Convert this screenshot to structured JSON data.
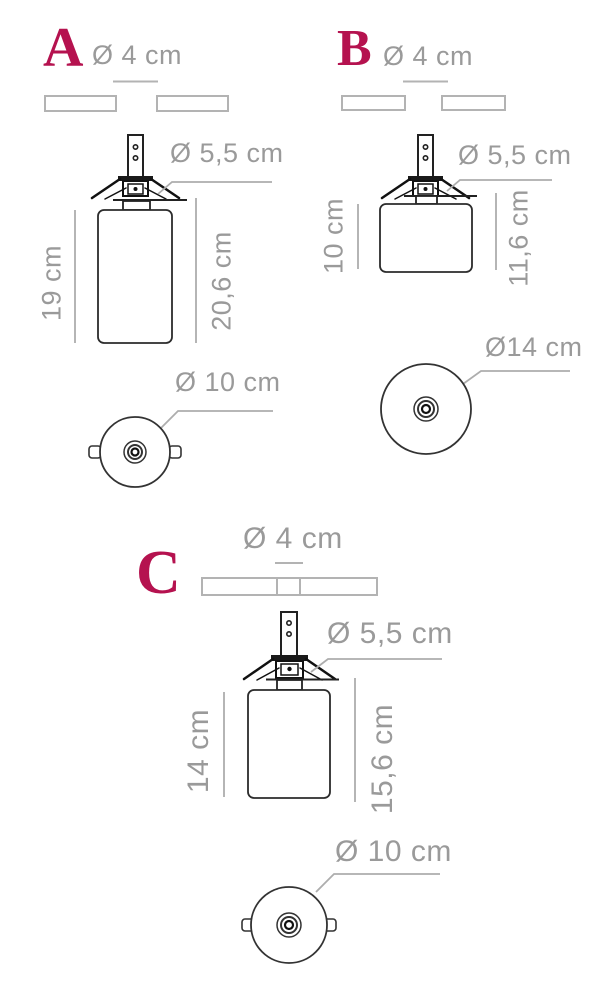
{
  "palette": {
    "accent": "#b5124f",
    "label_gray": "#9a9a9a",
    "line_gray": "#adadad",
    "line_dark": "#1f1f1f"
  },
  "variants": [
    {
      "id": "a",
      "letter": "A",
      "canopy_diameter": "Ø 4 cm",
      "clip_diameter": "Ø 5,5 cm",
      "body_height": "19 cm",
      "total_height": "20,6 cm",
      "bottom_diameter": "Ø 10 cm"
    },
    {
      "id": "b",
      "letter": "B",
      "canopy_diameter": "Ø 4 cm",
      "clip_diameter": "Ø 5,5 cm",
      "body_height": "10 cm",
      "total_height": "11,6 cm",
      "bottom_diameter": "Ø14 cm"
    },
    {
      "id": "c",
      "letter": "C",
      "canopy_diameter": "Ø 4 cm",
      "clip_diameter": "Ø 5,5 cm",
      "body_height": "14 cm",
      "total_height": "15,6 cm",
      "bottom_diameter": "Ø 10 cm"
    }
  ]
}
